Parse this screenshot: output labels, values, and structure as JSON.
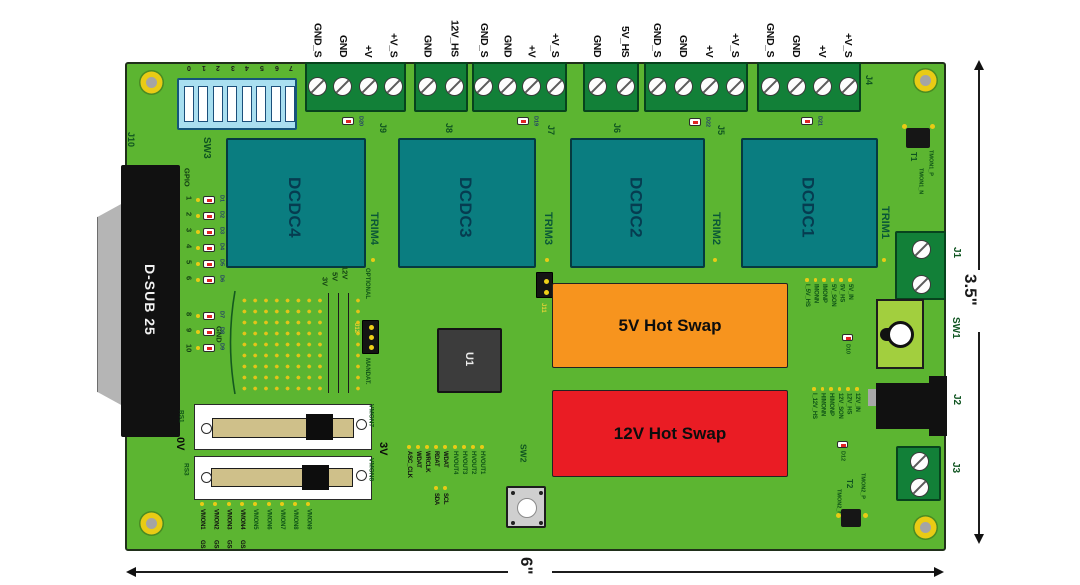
{
  "dimensions": {
    "height_label": "3.5\"",
    "width_label": "6\""
  },
  "top_connectors": [
    {
      "ref": "J9",
      "led": "D20",
      "pins": [
        "GND_S",
        "GND",
        "+V",
        "+V_S"
      ]
    },
    {
      "ref": "J8",
      "led": "",
      "pins": [
        "GND",
        "12V_HS"
      ]
    },
    {
      "ref": "J7",
      "led": "D19",
      "pins": [
        "GND_S",
        "GND",
        "+V",
        "+V_S"
      ]
    },
    {
      "ref": "J6",
      "led": "",
      "pins": [
        "GND",
        "5V_HS"
      ]
    },
    {
      "ref": "J5",
      "led": "D22",
      "pins": [
        "GND_S",
        "GND",
        "+V",
        "+V_S"
      ]
    },
    {
      "ref": "J4",
      "led": "D21",
      "pins": [
        "GND_S",
        "GND",
        "+V",
        "+V_S"
      ]
    }
  ],
  "dcdc_modules": [
    {
      "name": "DCDC4",
      "trim": "TRIM4"
    },
    {
      "name": "DCDC3",
      "trim": "TRIM3"
    },
    {
      "name": "DCDC2",
      "trim": "TRIM2"
    },
    {
      "name": "DCDC1",
      "trim": "TRIM1"
    }
  ],
  "hot_swap_5v": "5V Hot Swap",
  "hot_swap_12v": "12V Hot Swap",
  "ic_ref": "U1",
  "dsub": {
    "ref": "J10",
    "label": "D-SUB 25"
  },
  "dip": {
    "ref": "SW3",
    "positions": [
      "0",
      "1",
      "2",
      "3",
      "4",
      "5",
      "6",
      "7"
    ]
  },
  "gpio": {
    "label": "GPIO",
    "pins": [
      {
        "num": "1",
        "led": "D1"
      },
      {
        "num": "2",
        "led": "D2"
      },
      {
        "num": "3",
        "led": "D3"
      },
      {
        "num": "4",
        "led": "D4"
      },
      {
        "num": "5",
        "led": "D5"
      },
      {
        "num": "6",
        "led": "D6"
      },
      {
        "num": "8",
        "led": "D7"
      },
      {
        "num": "9",
        "led": "D8"
      },
      {
        "num": "10",
        "led": "D9"
      }
    ]
  },
  "proto": {
    "gnd_label": "GND",
    "rails": [
      "3V",
      "5V",
      "12V"
    ]
  },
  "j12": {
    "ref": "J12",
    "label_above": "OPTIONAL",
    "label_below": "MANDAT."
  },
  "j11_ref": "J11",
  "sliders": {
    "rs1_ref": "RS1",
    "rs3_ref": "RS3",
    "min_label": "0V",
    "max_label": "3V",
    "rs1_signal": "VMON7",
    "rs3_signal": "VMON8"
  },
  "vmon_row": [
    {
      "label": "VMON1",
      "suffix": "GS"
    },
    {
      "label": "VMON2",
      "suffix": "GS"
    },
    {
      "label": "VMON3",
      "suffix": "GS"
    },
    {
      "label": "VMON4",
      "suffix": "GS"
    },
    {
      "label": "VMON5"
    },
    {
      "label": "VMON6"
    },
    {
      "label": "VMON7"
    },
    {
      "label": "VMON8"
    },
    {
      "label": "VMON9"
    }
  ],
  "bus_signals": [
    {
      "label": "ASC_CLK"
    },
    {
      "label": "WDAT"
    },
    {
      "label": "WRCLK"
    },
    {
      "label": "RDAT",
      "alt": "SDA"
    },
    {
      "label": "WDAT",
      "alt": "SCL"
    }
  ],
  "hvout_signals": [
    "HVOUT4",
    "HVOUT3",
    "HVOUT2",
    "HVOUT1"
  ],
  "sw2_ref": "SW2",
  "sw1_ref": "SW1",
  "right_connectors": {
    "j1": "J1",
    "j2": "J2",
    "j3": "J3"
  },
  "t1": {
    "ref": "T1",
    "pos": "TMON1_P",
    "neg": "TMON1_N"
  },
  "t2": {
    "ref": "T2",
    "pos": "TMON2_P",
    "neg": "TMON2_N"
  },
  "sense_5v": {
    "led": "D10",
    "labels": [
      "I_5V_HS",
      "IMONN",
      "IMONP",
      "5V_SON",
      "5V_HS",
      "5V_IN"
    ]
  },
  "sense_12v": {
    "led": "D12",
    "labels": [
      "I_12V_HS",
      "HIMONN",
      "HIMONP",
      "12V_SON",
      "12V_HS",
      "12V_IN"
    ]
  }
}
